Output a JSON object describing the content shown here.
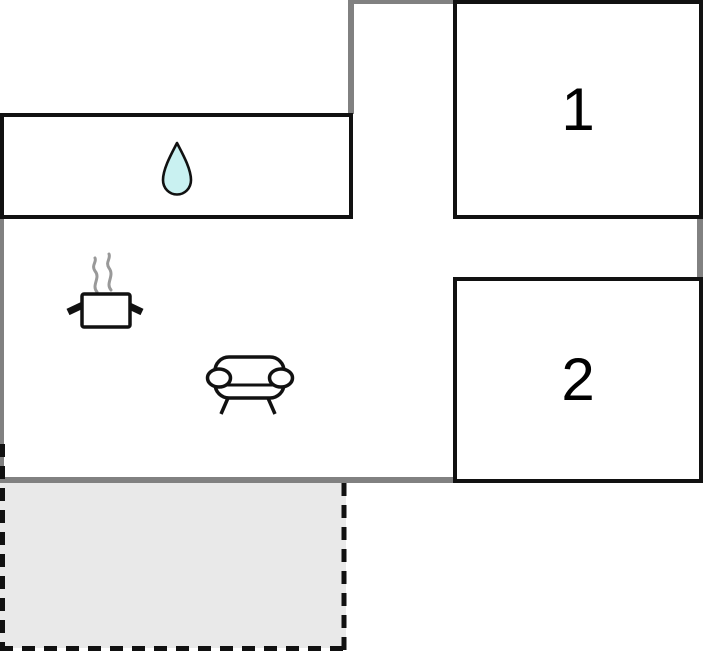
{
  "floor_plan": {
    "rooms": [
      {
        "id": "room-1",
        "label": "1"
      },
      {
        "id": "room-2",
        "label": "2"
      },
      {
        "id": "bathroom",
        "icon": "water-drop-icon"
      },
      {
        "id": "living-area",
        "icons": [
          "cooking-pot-icon",
          "sofa-icon"
        ]
      },
      {
        "id": "terrace",
        "outline": "dashed"
      }
    ],
    "colors": {
      "wall_gray": "#818181",
      "room_border": "#111111",
      "terrace_fill": "#e9e9e9",
      "dash_black": "#111111",
      "water_drop_fill": "#c9f1f1",
      "steam_gray": "#999999",
      "background": "#ffffff"
    }
  }
}
